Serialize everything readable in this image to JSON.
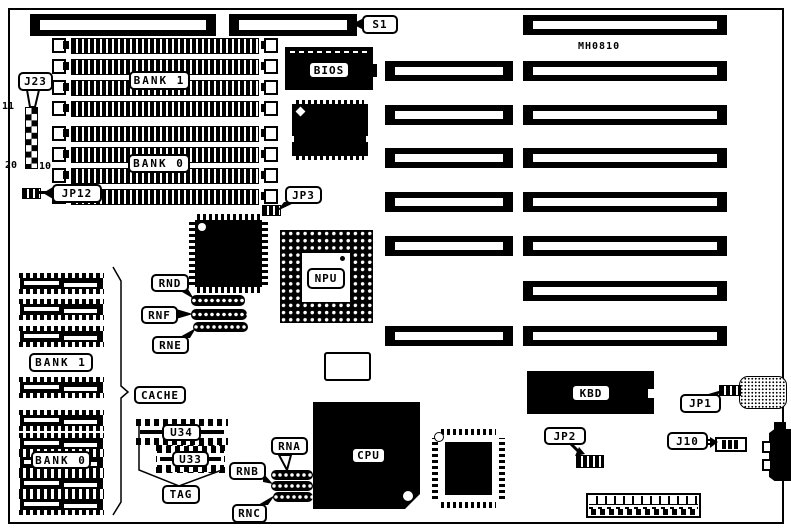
{
  "board": {
    "part_number": "MH0810"
  },
  "callouts": {
    "s1": "S1",
    "j23": "J23",
    "jp12": "JP12",
    "jp3": "JP3",
    "rnd": "RND",
    "rnf": "RNF",
    "rne": "RNE",
    "cache": "CACHE",
    "tag": "TAG",
    "rna": "RNA",
    "rnb": "RNB",
    "rnc": "RNC",
    "jp1": "JP1",
    "jp2": "JP2",
    "j10": "J10"
  },
  "chips": {
    "bios": "BIOS",
    "npu": "NPU",
    "cpu": "CPU",
    "kbd": "KBD",
    "u34": "U34",
    "u33": "U33"
  },
  "memory": {
    "simm_bank1": "BANK 1",
    "simm_bank0": "BANK 0",
    "cache_bank1": "BANK 1",
    "cache_bank0": "BANK 0"
  },
  "j23_pins": {
    "pin11": "11",
    "pin20": "20",
    "pin10": "10"
  }
}
